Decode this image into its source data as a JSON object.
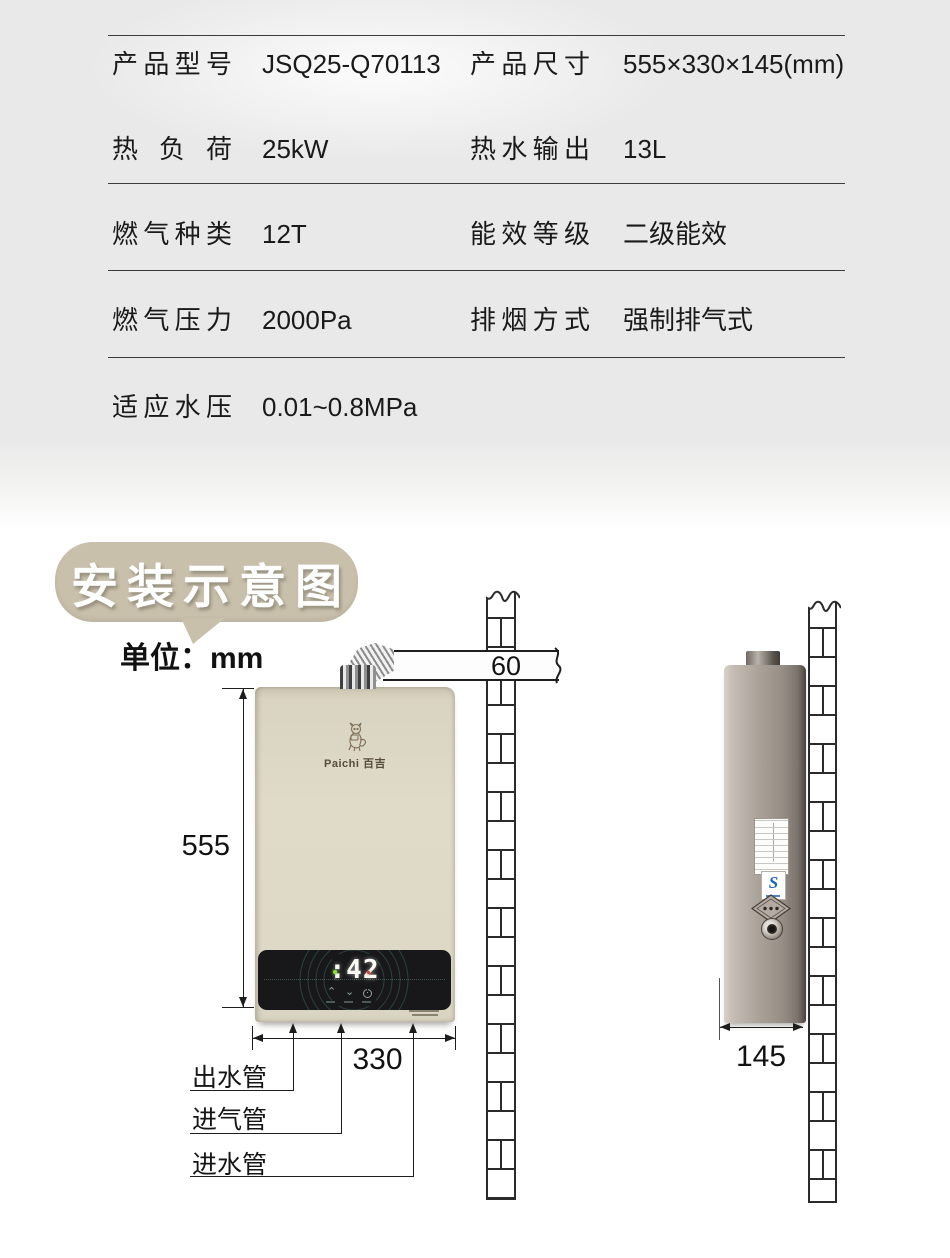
{
  "specs": {
    "rows": [
      {
        "l1": "产品型号",
        "v1": "JSQ25-Q70113",
        "l2": "产品尺寸",
        "v2": "555×330×145(mm)"
      },
      {
        "l1": "热负荷",
        "v1": "25kW",
        "l2": "热水输出",
        "v2": "13L"
      },
      {
        "l1": "燃气种类",
        "v1": "12T",
        "l2": "能效等级",
        "v2": "二级能效"
      },
      {
        "l1": "燃气压力",
        "v1": "2000Pa",
        "l2": "排烟方式",
        "v2": "强制排气式"
      },
      {
        "l1": "适应水压",
        "v1": "0.01~0.8MPa"
      }
    ]
  },
  "install": {
    "title": "安装示意图",
    "unit": "单位：mm",
    "brand": "Paichi 百吉",
    "display_temp": ":42",
    "dims": {
      "height": "555",
      "width": "330",
      "depth": "145",
      "duct": "60"
    },
    "pipes": [
      {
        "label": "出水管"
      },
      {
        "label": "进气管"
      },
      {
        "label": "进水管"
      }
    ]
  },
  "colors": {
    "bubble_tan": "#c9c0ac",
    "heater_beige": "#ddd6c4",
    "panel_black": "#18181a",
    "indicator_green": "#8ae335",
    "indicator_red": "#e23b2e",
    "cert_blue": "#1766c2",
    "table_bg_gray": "#e9e9e9"
  }
}
